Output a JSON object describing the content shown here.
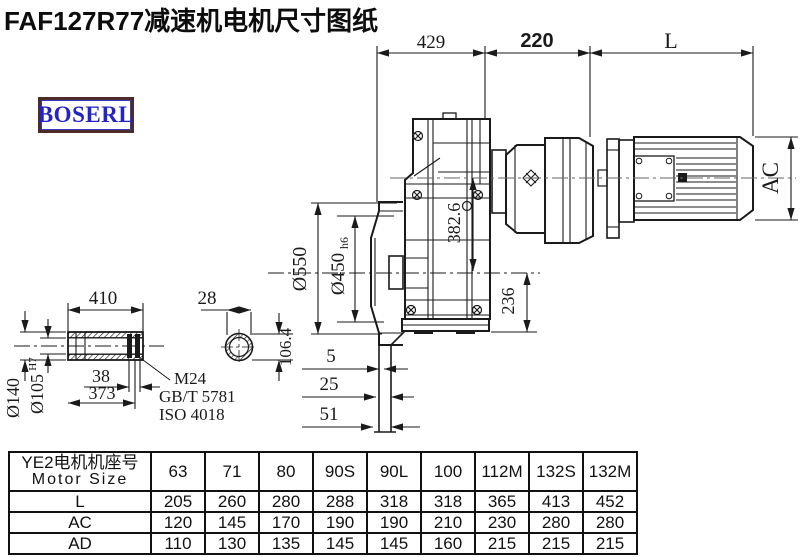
{
  "title": "FAF127R77减速机电机尺寸图纸",
  "logo": {
    "text": "BOSERL",
    "text_color": "#2323c8",
    "border_color": "#4d2b28"
  },
  "colors": {
    "line": "#1a1a1a",
    "background": "#ffffff"
  },
  "drawing": {
    "top_dims": {
      "d429": "429",
      "d220": "220",
      "dL": "L"
    },
    "left_dims": {
      "d550": "Ø550",
      "d450": "Ø450",
      "d450_suffix": "h6",
      "d382": "382.6",
      "d236": "236"
    },
    "offset_dims": {
      "d5": "5",
      "d25": "25",
      "d51": "51"
    },
    "motor_dims": {
      "dAC": "AC"
    },
    "shaft_dims": {
      "d410": "410",
      "d28": "28",
      "d38": "38",
      "d373": "373",
      "d140": "Ø140",
      "d105": "Ø105",
      "d105_suffix": "H7",
      "d106": "106.4"
    },
    "notes": {
      "thread": "M24",
      "standard1": "GB/T 5781",
      "standard2": "ISO 4018"
    }
  },
  "table": {
    "header_line1": "YE2电机机座号",
    "header_line2": "Motor Size",
    "sizes": [
      "63",
      "71",
      "80",
      "90S",
      "90L",
      "100",
      "112M",
      "132S",
      "132M"
    ],
    "rows": [
      {
        "label": "L",
        "values": [
          "205",
          "260",
          "280",
          "288",
          "318",
          "318",
          "365",
          "413",
          "452"
        ]
      },
      {
        "label": "AC",
        "values": [
          "120",
          "145",
          "170",
          "190",
          "190",
          "210",
          "230",
          "280",
          "280"
        ]
      },
      {
        "label": "AD",
        "values": [
          "110",
          "130",
          "135",
          "145",
          "145",
          "160",
          "215",
          "215",
          "215"
        ]
      }
    ]
  }
}
